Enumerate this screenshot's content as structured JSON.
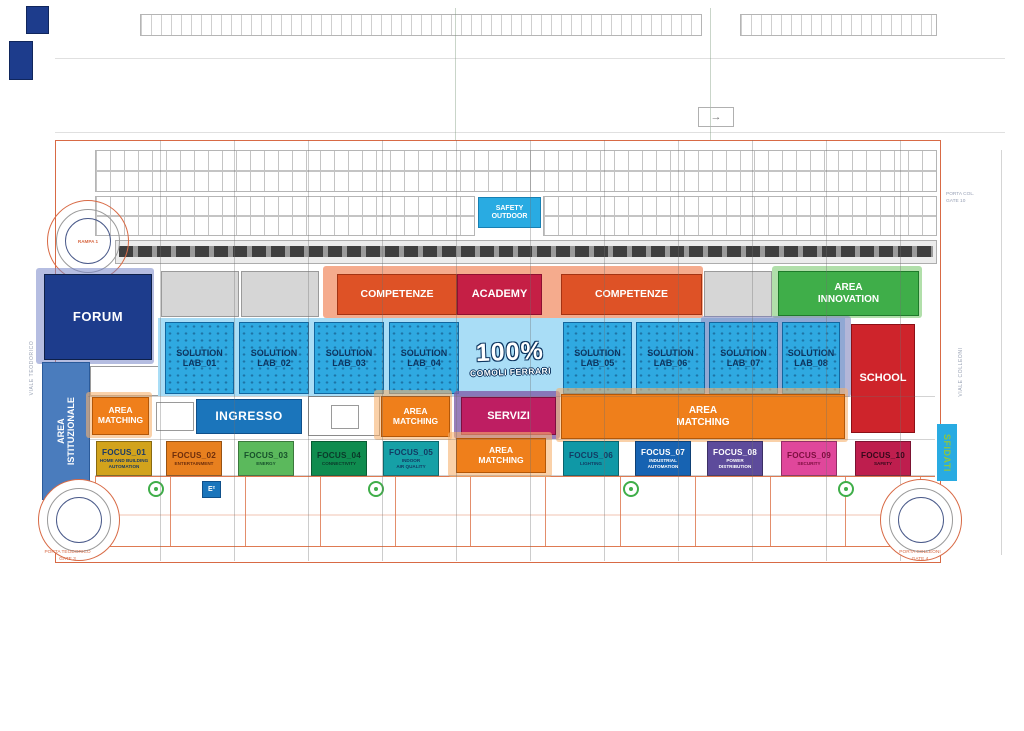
{
  "plan": {
    "streets": {
      "left": "VIALE TEODORICO",
      "right": "VIALE COLLEONI"
    },
    "gates": {
      "top_right": "PORTA COL.\nGATE 10",
      "bottom_left": "PORTA TEODORICO\nGATE 3",
      "bottom_right": "PORTA COLLEONI\nGATE 4"
    },
    "ramp": "RAMPA 1",
    "direction_arrow": "→"
  },
  "zones": {
    "safety_outdoor": {
      "label": "SAFETY\nOUTDOOR",
      "color": "#29ABE2"
    },
    "forum": {
      "label": "FORUM",
      "color": "#1D3C8C"
    },
    "area_istituzionale": {
      "label": "AREA\nISTITUZIONALE",
      "color": "#4A7CBD"
    },
    "competenze_left": {
      "label": "COMPETENZE",
      "color": "#DE5226"
    },
    "academy": {
      "label": "ACADEMY",
      "color": "#C51F45"
    },
    "competenze_right": {
      "label": "COMPETENZE",
      "color": "#DE5226"
    },
    "area_innovation": {
      "label": "AREA\nINNOVATION",
      "color": "#3FAE49"
    },
    "solution_labs": [
      "SOLUTION\nLAB_01",
      "SOLUTION\nLAB_02",
      "SOLUTION\nLAB_03",
      "SOLUTION\nLAB_04",
      "SOLUTION\nLAB_05",
      "SOLUTION\nLAB_06",
      "SOLUTION\nLAB_07",
      "SOLUTION\nLAB_08"
    ],
    "center_brand": {
      "line1": "100%",
      "line2": "COMOLI FERRARI"
    },
    "school": {
      "label": "SCHOOL",
      "color": "#CE242B"
    },
    "ingresso": {
      "label": "INGRESSO",
      "color": "#1B75BB"
    },
    "servizi": {
      "label": "SERVIZI",
      "color": "#BE1E62"
    },
    "area_matching": {
      "label": "AREA\nMATCHING",
      "color": "#EF7F1B"
    },
    "sfidati": {
      "label": "SFIDATI",
      "bg": "#29ABE2",
      "fg": "#8DC63F"
    },
    "e2": "E²"
  },
  "focus_areas": [
    {
      "id": "FOCUS_01",
      "subtitle": "HOME AND BUILDING\nAUTOMATION",
      "bg": "#D2A31C",
      "fg": "#1B3A66"
    },
    {
      "id": "FOCUS_02",
      "subtitle": "ENTERTAINMENT",
      "bg": "#E8801F",
      "fg": "#6E2E0C"
    },
    {
      "id": "FOCUS_03",
      "subtitle": "ENERGY",
      "bg": "#5BB95C",
      "fg": "#17512B"
    },
    {
      "id": "FOCUS_04",
      "subtitle": "CONNECTIVITY",
      "bg": "#0F8C4F",
      "fg": "#0A3A2A"
    },
    {
      "id": "FOCUS_05",
      "subtitle": "INDOOR\nAIR QUALITY",
      "bg": "#16A0A6",
      "fg": "#123B63"
    },
    {
      "id": "FOCUS_06",
      "subtitle": "LIGHTING",
      "bg": "#0F98A6",
      "fg": "#123B63"
    },
    {
      "id": "FOCUS_07",
      "subtitle": "INDUSTRIAL\nAUTOMATION",
      "bg": "#1763B2",
      "fg": "#FFFFFF"
    },
    {
      "id": "FOCUS_08",
      "subtitle": "POWER\nDISTRIBUTION",
      "bg": "#5D4B9B",
      "fg": "#FFFFFF"
    },
    {
      "id": "FOCUS_09",
      "subtitle": "SECURITY",
      "bg": "#E0479B",
      "fg": "#7C0E3E"
    },
    {
      "id": "FOCUS_10",
      "subtitle": "SAFETY",
      "bg": "#BE1E4E",
      "fg": "#33081A"
    }
  ]
}
